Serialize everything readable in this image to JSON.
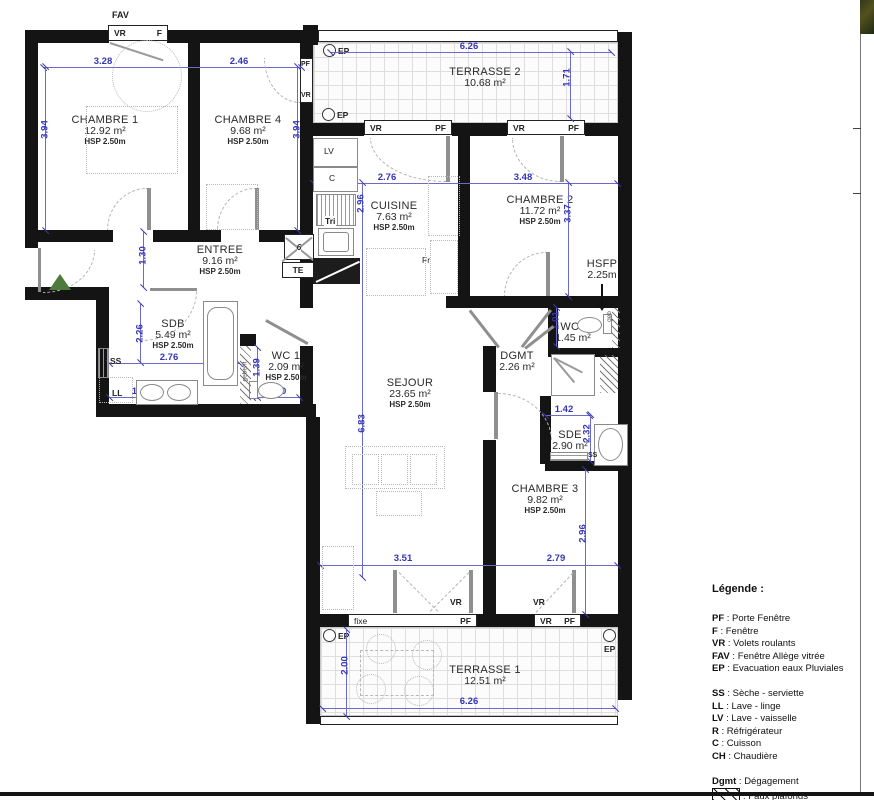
{
  "plan": {
    "labels": {
      "fav": "FAV",
      "vr": "VR",
      "f": "F",
      "pf": "PF",
      "ep": "EP",
      "fixe": "fixe",
      "te": "TE",
      "tri": "Tri",
      "fr": "Fr",
      "lv": "LV",
      "c": "C",
      "ss": "SS",
      "ll": "LL",
      "geberit": "geberit",
      "geb": "geb",
      "shaft": "6"
    },
    "rooms": {
      "chambre1": {
        "name": "CHAMBRE 1",
        "area": "12.92 m²",
        "hsp": "HSP 2.50m"
      },
      "chambre4": {
        "name": "CHAMBRE 4",
        "area": "9.68 m²",
        "hsp": "HSP 2.50m"
      },
      "entree": {
        "name": "ENTREE",
        "area": "9.16 m²",
        "hsp": "HSP 2.50m"
      },
      "terrasse2": {
        "name": "TERRASSE 2",
        "area": "10.68 m²"
      },
      "cuisine": {
        "name": "CUISINE",
        "area": "7.63 m²",
        "hsp": "HSP 2.50m"
      },
      "chambre2": {
        "name": "CHAMBRE 2",
        "area": "11.72 m²",
        "hsp": "HSP 2.50m"
      },
      "sdb": {
        "name": "SDB",
        "area": "5.49 m²",
        "hsp": "HSP 2.50m"
      },
      "wc1": {
        "name": "WC 1",
        "area": "2.09 m²",
        "hsp": "HSP 2.50m"
      },
      "sejour": {
        "name": "SEJOUR",
        "area": "23.65 m²",
        "hsp": "HSP 2.50m"
      },
      "dgmt": {
        "name": "DGMT",
        "area": "2.26 m²"
      },
      "wc2": {
        "name": "WC2",
        "area": "1.45 m²"
      },
      "sde": {
        "name": "SDE",
        "area": "2.90 m²"
      },
      "chambre3": {
        "name": "CHAMBRE 3",
        "area": "9.82 m²",
        "hsp": "HSP 2.50m"
      },
      "terrasse1": {
        "name": "TERRASSE 1",
        "area": "12.51 m²"
      }
    },
    "hsfp": {
      "name": "HSFP",
      "value": "2.25m"
    },
    "dims": {
      "chambre1_width": "3.28",
      "chambre4_width": "2.46",
      "chambres_height_left": "3.94",
      "chambres_height_right": "3.94",
      "terrasse2_width": "6.26",
      "terrasse2_depth": "1.71",
      "cuisine_width": "2.76",
      "chambre2_width": "3.48",
      "cuisine_height": "2.96",
      "chambre2_height": "3.37",
      "entree_dim": "1.30",
      "sdb_height": "2.26",
      "sdb_width": "2.76",
      "sdb_counter": "1.97",
      "wc1_height": "1.39",
      "wc1_width": "1.50",
      "wc2_height": "1.01",
      "sde_width": "1.42",
      "sde_height": "2.32",
      "sejour_height": "6.83",
      "sejour_width": "3.51",
      "chambre3_width": "2.79",
      "chambre3_height": "2.96",
      "terrasse1_depth": "2.00",
      "terrasse1_width": "6.26"
    }
  },
  "legend": {
    "title": "Légende :",
    "items1": [
      {
        "key": "PF",
        "desc": ": Porte Fenêtre"
      },
      {
        "key": "F",
        "desc": ": Fenêtre"
      },
      {
        "key": "VR",
        "desc": ": Volets roulants"
      },
      {
        "key": "FAV",
        "desc": ": Fenêtre Allège vitrée"
      },
      {
        "key": "EP",
        "desc": ": Evacuation eaux Pluviales"
      }
    ],
    "items2": [
      {
        "key": "SS",
        "desc": ": Sèche - serviette"
      },
      {
        "key": "LL",
        "desc": ": Lave - linge"
      },
      {
        "key": "LV",
        "desc": ": Lave - vaisselle"
      },
      {
        "key": "R",
        "desc": ": Réfrigérateur"
      },
      {
        "key": "C",
        "desc": ": Cuisson"
      },
      {
        "key": "CH",
        "desc": ": Chaudière"
      }
    ],
    "dgmt": {
      "key": "Dgmt",
      "desc": ": Dégagement"
    },
    "faux_plafonds": ": Faux plafonds"
  },
  "colors": {
    "dimension_blue": "#3434b8",
    "wall_black": "#141414",
    "entrance_green": "#4e7a3c"
  }
}
